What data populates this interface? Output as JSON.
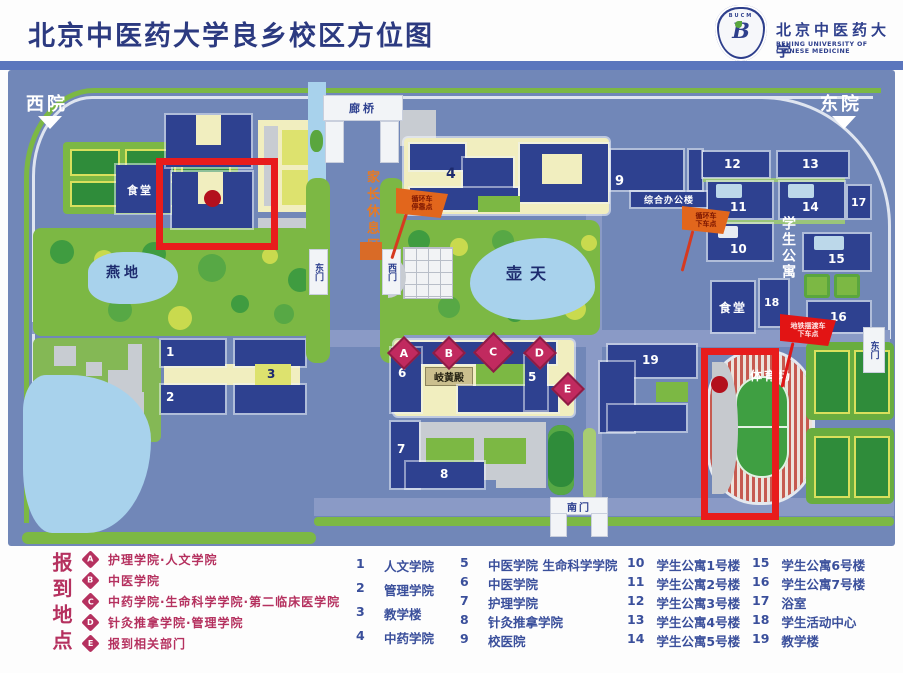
{
  "header": {
    "title": "北京中医药大学良乡校区方位图",
    "logo": {
      "abbr": "BUCM",
      "name_cn": "北京中医药大学",
      "name_en": "BEIJING UNIVERSITY OF CHINESE MEDICINE"
    }
  },
  "map": {
    "districts": {
      "west": "西院",
      "east": "东院"
    },
    "gates": {
      "corridor_east": "东门",
      "corridor_west": "西门",
      "south": "南门",
      "east": "东门"
    },
    "places": {
      "bridge": "廊桥",
      "parent_rest_area": "家长休息区",
      "canteen_west": "食堂",
      "canteen_east": "食堂",
      "yandi_garden": "燕地",
      "hutian_garden": "壶天",
      "qihuang_hall": "岐黄殿",
      "admin_building": "综合办公楼",
      "student_apartments": "学生公寓",
      "stadium": "体育场"
    },
    "flags": {
      "shuttle_stop_line1": "循环车",
      "shuttle_stop_line2": "停靠点",
      "shuttle_dropoff_line1": "循环车",
      "shuttle_dropoff_line2": "下车点",
      "metro_dropoff_line1": "地铁摆渡车",
      "metro_dropoff_line2": "下车点"
    },
    "building_numbers": {
      "b1": "1",
      "b2": "2",
      "b3": "3",
      "b4": "4",
      "b5": "5",
      "b6": "6",
      "b7": "7",
      "b8": "8",
      "b9": "9",
      "b10": "10",
      "b11": "11",
      "b12": "12",
      "b13": "13",
      "b14": "14",
      "b15": "15",
      "b16": "16",
      "b17": "17",
      "b18": "18",
      "b19": "19"
    },
    "checkin_markers": {
      "A": "A",
      "B": "B",
      "C": "C",
      "D": "D",
      "E": "E"
    }
  },
  "legend": {
    "checkin": {
      "title": "报到地点",
      "items": [
        {
          "key": "A",
          "label": "护理学院·人文学院"
        },
        {
          "key": "B",
          "label": "中医学院"
        },
        {
          "key": "C",
          "label": "中药学院·生命科学学院·第二临床医学院"
        },
        {
          "key": "D",
          "label": "针灸推拿学院·管理学院"
        },
        {
          "key": "E",
          "label": "报到相关部门"
        }
      ]
    },
    "buildings": {
      "col1": [
        {
          "num": "1",
          "label": "人文学院"
        },
        {
          "num": "2",
          "label": "管理学院"
        },
        {
          "num": "3",
          "label": "教学楼"
        },
        {
          "num": "4",
          "label": "中药学院"
        }
      ],
      "col2": [
        {
          "num": "5",
          "label": "中医学院 生命科学学院"
        },
        {
          "num": "6",
          "label": "中医学院"
        },
        {
          "num": "7",
          "label": "护理学院"
        },
        {
          "num": "8",
          "label": "针灸推拿学院"
        },
        {
          "num": "9",
          "label": "校医院"
        }
      ],
      "col3": [
        {
          "num": "10",
          "label": "学生公寓1号楼"
        },
        {
          "num": "11",
          "label": "学生公寓2号楼"
        },
        {
          "num": "12",
          "label": "学生公寓3号楼"
        },
        {
          "num": "13",
          "label": "学生公寓4号楼"
        },
        {
          "num": "14",
          "label": "学生公寓5号楼"
        }
      ],
      "col4": [
        {
          "num": "15",
          "label": "学生公寓6号楼"
        },
        {
          "num": "16",
          "label": "学生公寓7号楼"
        },
        {
          "num": "17",
          "label": "浴室"
        },
        {
          "num": "18",
          "label": "学生活动中心"
        },
        {
          "num": "19",
          "label": "教学楼"
        }
      ]
    }
  },
  "colors": {
    "title_navy": "#2c3a80",
    "map_background": "#7187b8",
    "building_navy": "#2e4190",
    "lawn_green": "#7cb844",
    "courtyard_cream": "#f1eebf",
    "water_blue": "#a8d2ec",
    "highlight_red": "#e81c1c",
    "marker_crimson": "#c12a5f",
    "flag_orange": "#e2661c",
    "legend_text_blue": "#3a4f9b"
  }
}
